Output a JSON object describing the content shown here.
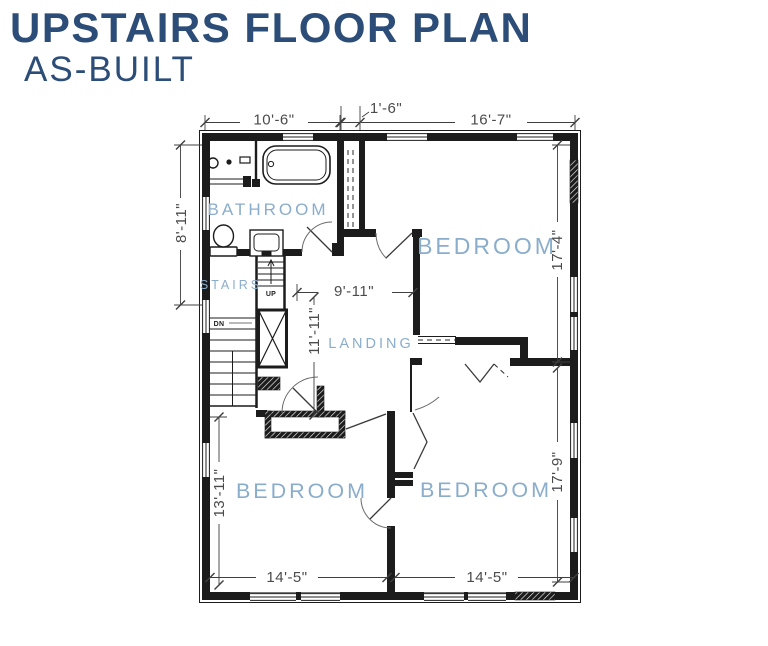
{
  "title": {
    "line1": "UPSTAIRS FLOOR PLAN",
    "line2": "AS-BUILT"
  },
  "rooms": {
    "bathroom": {
      "label": "BATHROOM"
    },
    "stairs": {
      "label": "STAIRS"
    },
    "landing": {
      "label": "LANDING"
    },
    "bedroom_top_right": {
      "label": "BEDROOM"
    },
    "bedroom_bottom_left": {
      "label": "BEDROOM"
    },
    "bedroom_bottom_right": {
      "label": "BEDROOM"
    }
  },
  "stair_marks": {
    "up": "UP",
    "down": "DN"
  },
  "dimensions": {
    "top_left": "10'-6\"",
    "top_middle": "1'-6\"",
    "top_right": "16'-7\"",
    "left_bathroom": "8'-11\"",
    "left_bedroom": "13'-11\"",
    "right_bedroom_upper": "17'-4\"",
    "right_bedroom_lower": "17'-9\"",
    "landing_width": "9'-11\"",
    "landing_height": "11'-11\"",
    "bottom_bedroom_left": "14'-5\"",
    "bottom_bedroom_right": "14'-5\""
  },
  "colors": {
    "title": "#2b4d78",
    "room_label": "#8aadcc",
    "dimension_text": "#4b4b4b",
    "wall": "#1c1c1c",
    "background": "#ffffff"
  }
}
